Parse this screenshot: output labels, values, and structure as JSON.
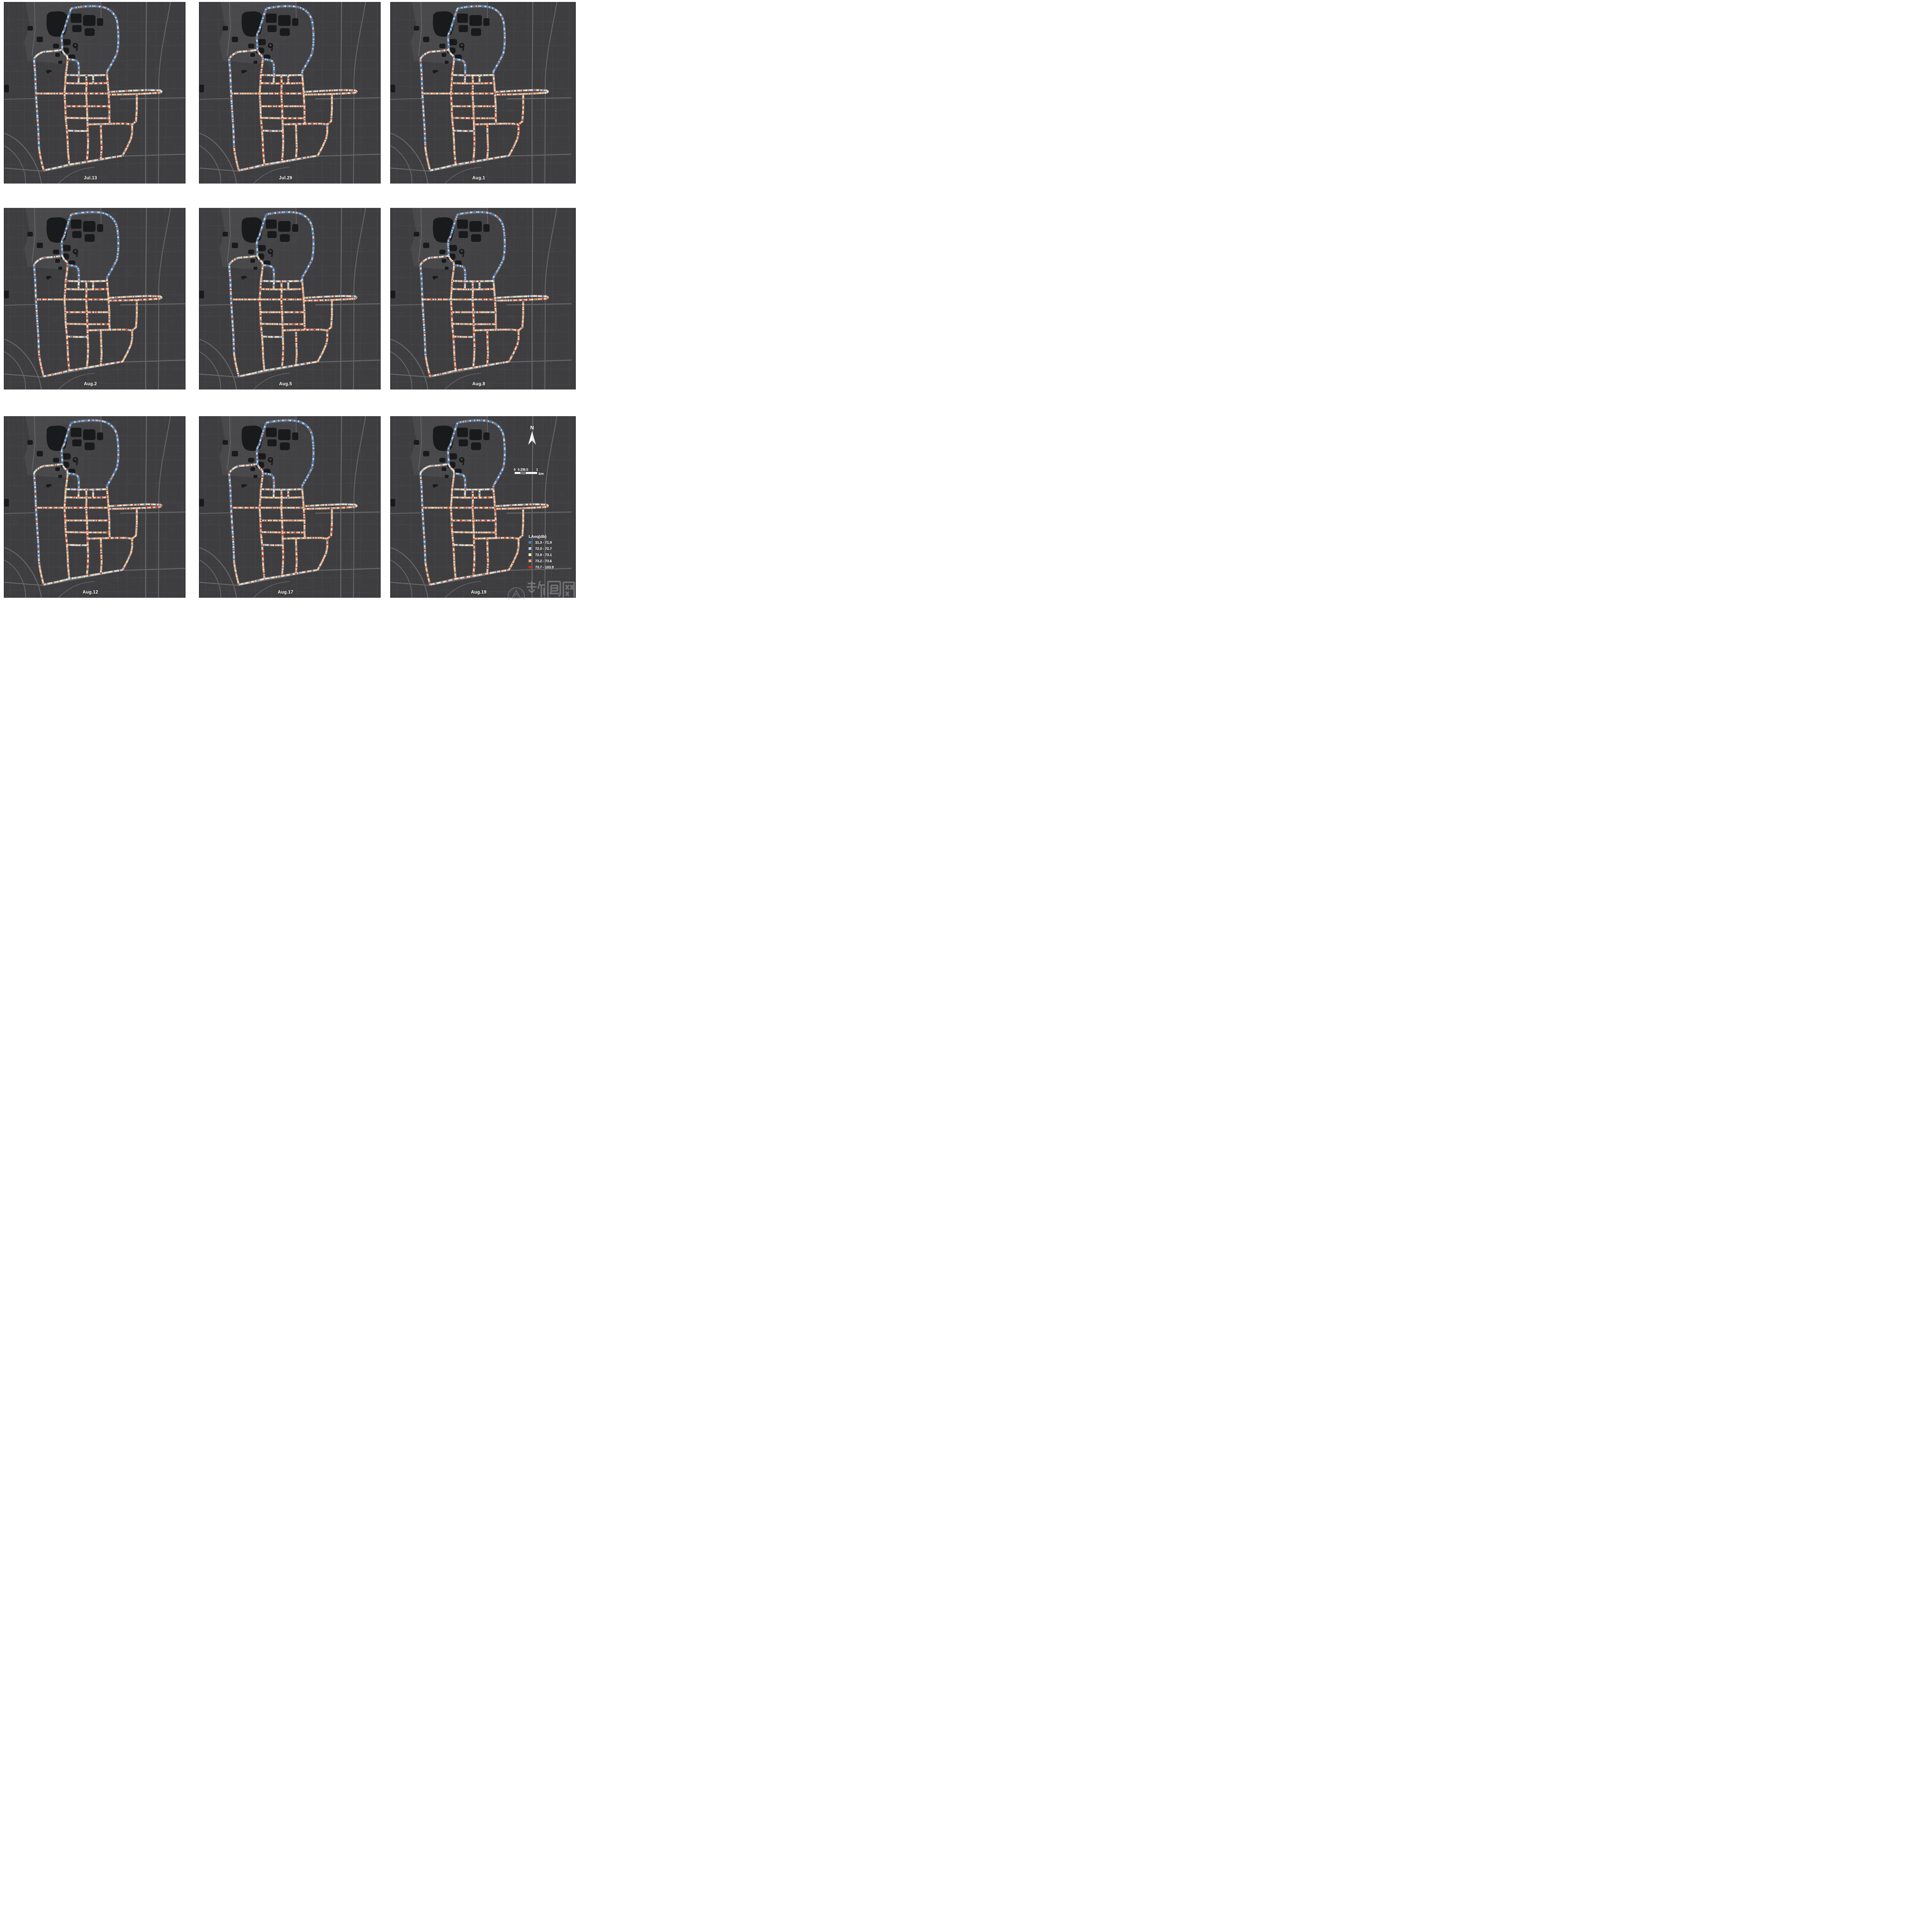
{
  "figure": {
    "panels": [
      {
        "id": "jul13",
        "date": "Jul.13"
      },
      {
        "id": "jul29",
        "date": "Jul.29"
      },
      {
        "id": "aug1",
        "date": "Aug.1"
      },
      {
        "id": "aug2",
        "date": "Aug.2"
      },
      {
        "id": "aug5",
        "date": "Aug.5"
      },
      {
        "id": "aug8",
        "date": "Aug.8"
      },
      {
        "id": "aug12",
        "date": "Aug.12"
      },
      {
        "id": "aug17",
        "date": "Aug.17"
      },
      {
        "id": "aug19",
        "date": "Aug.19"
      }
    ],
    "legend": {
      "title": "LAeq(db)",
      "items": [
        {
          "label": "31.3 - 71.9",
          "color": "#4a7ac1"
        },
        {
          "label": "72.0 - 72.7",
          "color": "#b8c9d2"
        },
        {
          "label": "72.8 - 73.1",
          "color": "#fdf8b9"
        },
        {
          "label": "73.2 - 73.6",
          "color": "#f4a46c"
        },
        {
          "label": "73.7 - 103.9",
          "color": "#d52b17"
        }
      ]
    },
    "north_arrow": {
      "label": "N"
    },
    "scale_bar": {
      "ticks": [
        "0",
        "0.25",
        "0.5",
        "1"
      ],
      "unit": "km"
    },
    "watermark": {
      "text": "新闻网",
      "seal_caption": "UNIVERSITY OF TECHNOLOGY"
    }
  },
  "map_style": {
    "background": "#3e3e40",
    "road_casing": "#b9bdb9",
    "noise_colors": {
      "quiet_blue": "#4d7cbe",
      "light_gray_blue": "#b8c9d2",
      "cream": "#efe9d3",
      "pale_yellow": "#fdf8b9",
      "orange": "#f0a26b",
      "red": "#d2381f"
    }
  }
}
